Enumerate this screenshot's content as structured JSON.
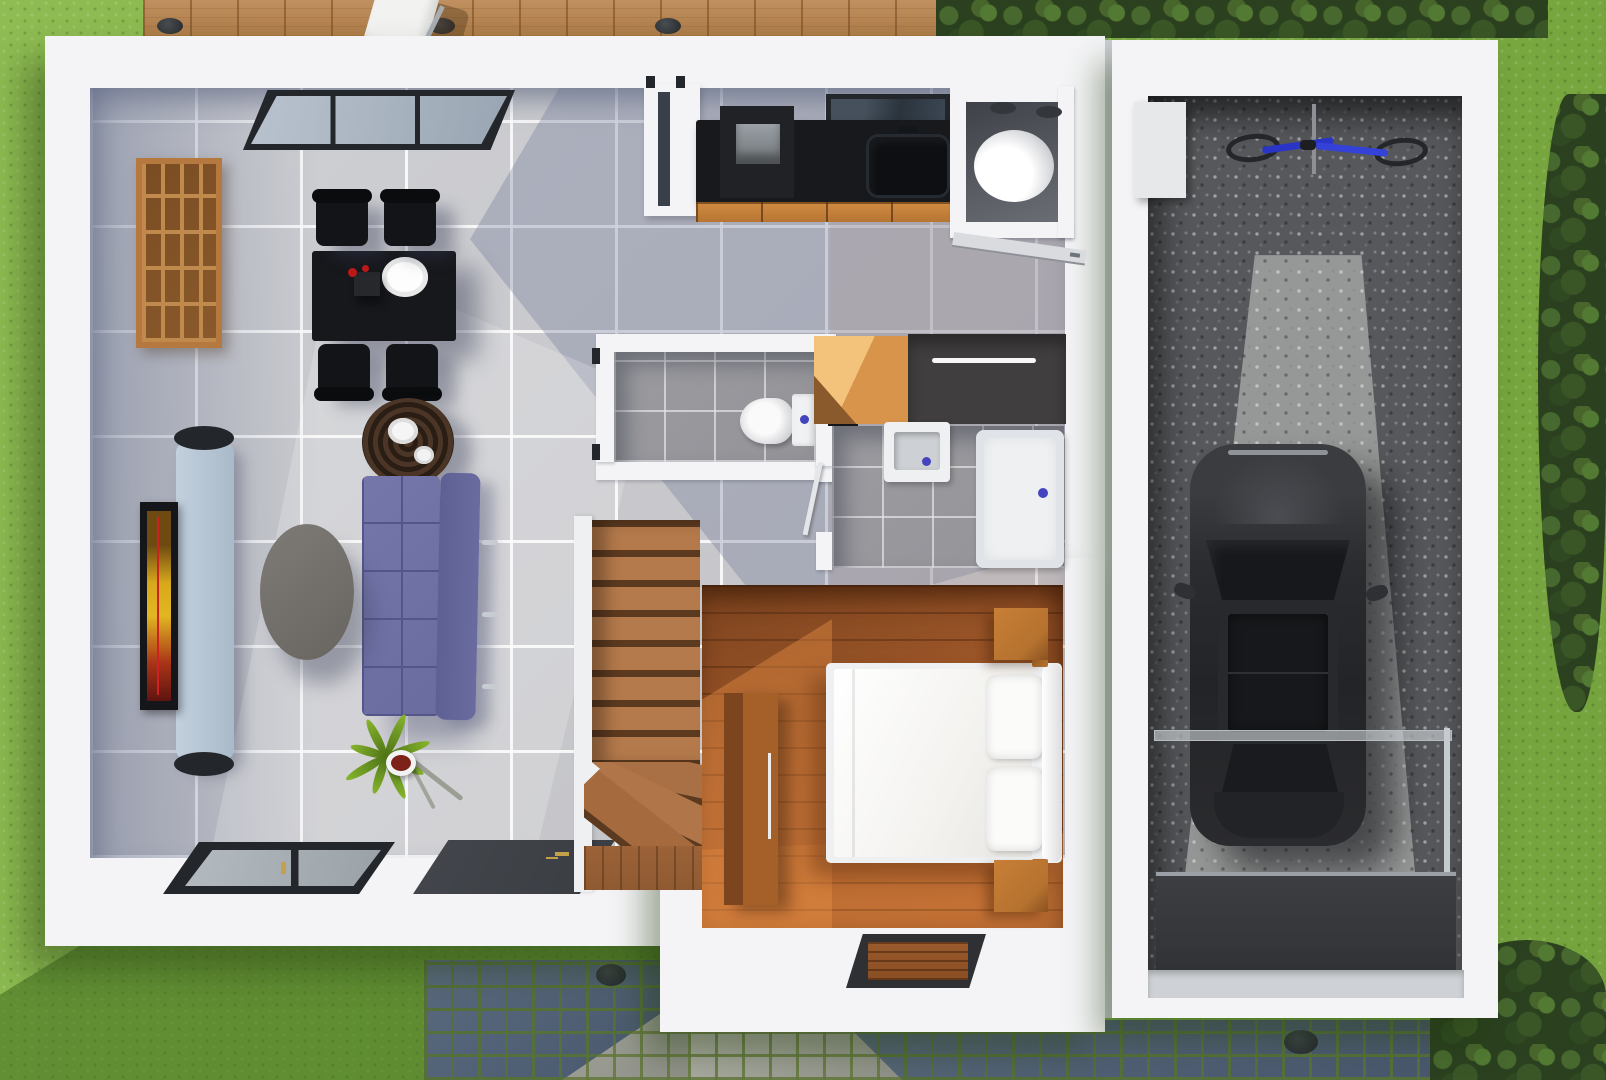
{
  "scene": {
    "description": "3D rendered top-down floor plan of a single-storey house with attached garage, lawn, wooden deck and cobblestone paths",
    "rooms": [
      {
        "name": "living-dining-room",
        "objects": [
          "bookshelf",
          "dining-table",
          "dining-chairs",
          "round-side-table",
          "purple-sofa",
          "oval-coffee-table",
          "tv-panel",
          "tv",
          "house-plant",
          "sliding-window",
          "front-door"
        ]
      },
      {
        "name": "kitchen",
        "objects": [
          "black-countertop",
          "stove",
          "sink",
          "faucet",
          "wood-cabinets",
          "wall-window"
        ]
      },
      {
        "name": "utility-room",
        "objects": [
          "water-heater",
          "ceiling-vents",
          "open-door"
        ]
      },
      {
        "name": "wc",
        "objects": [
          "toilet",
          "cistern-button"
        ]
      },
      {
        "name": "bathroom",
        "objects": [
          "washbasin",
          "shower-tray",
          "drains",
          "door"
        ]
      },
      {
        "name": "hallway",
        "objects": [
          "orange-closet",
          "dark-wardrobe"
        ]
      },
      {
        "name": "staircase",
        "objects": [
          "wood-steps",
          "winder-steps"
        ]
      },
      {
        "name": "bedroom",
        "objects": [
          "double-bed",
          "pillows",
          "nightstands",
          "wardrobe",
          "doormat"
        ]
      },
      {
        "name": "garage",
        "objects": [
          "car",
          "bicycle",
          "wall-unit",
          "glass-railing",
          "entry-ramp"
        ]
      }
    ],
    "outdoor": [
      "lawn",
      "wooden-deck",
      "deck-lounge-chair",
      "tree-canopies",
      "cobblestone-path",
      "storm-drains",
      "gravel-floor"
    ]
  },
  "colors": {
    "grassBase": "#7fae45",
    "grassLight": "#8fbd53",
    "grassShadow": "#3f6b1e",
    "treeDark": "#2b401f",
    "deckWood": "#c09060",
    "deckSeam": "#744820",
    "cobbleJoint": "#55703a",
    "cobbleDark1": "#5a6a7e",
    "cobbleDark2": "#47566b",
    "cobbleL1": "#b0b1a7",
    "cobbleL2": "#8f9188",
    "wallWhite": "#f4f4f6",
    "wallShade": "#ccd0d6",
    "tileBase1": "#cfd0d4",
    "tileBase2": "#c2c2c6",
    "counterBlack": "#17191d",
    "cabinetWood": "#cf8a41",
    "stoveGray": "#9aa0a5",
    "frameDark": "#23262b",
    "glass1": "#b9c3cf",
    "glass2": "#99a5b2",
    "bathTile": "#939398",
    "fixtureWhite": "#eef0f2",
    "drainBlue": "#4444bf",
    "closetOrangeA": "#f3c37c",
    "closetOrangeB": "#d9944b",
    "closetDark": "#413e3f",
    "utilityDark": "#595c63",
    "boilerWhite": "#ffffff",
    "woodA": "#7c431e",
    "woodB": "#a2592a",
    "woodSun": "#e89045",
    "stairWood": "#b57a4b",
    "stairShadow": "#5c3a20",
    "bedWhite": "#f3f2ef",
    "nightWood": "#b5722f",
    "wardrobeA": "#7c451d",
    "wardrobeB": "#a55f28",
    "sofaPurple": "#6a6b9f",
    "sofaSeam": "#54558a",
    "tableBlack": "#17181c",
    "chairBlack": "#131417",
    "tvPanelA": "#c2d0de",
    "tvPanelB": "#a9bac9",
    "tvFrame": "#15161a",
    "screenAmber": "#e2b722",
    "screenRed": "#a83417",
    "coffeeA": "#7e7b76",
    "coffeeB": "#686560",
    "sideWoodA": "#4a3526",
    "sideWoodB": "#2a1d14",
    "plantGreen": "#6b9623",
    "potMaroon": "#7c2218",
    "gravelBase": "#56585b",
    "gravelLight": "#a2a4a3",
    "carBody": "#2b2c2f",
    "carGlass": "#17181b",
    "carLight": "#4b4d52",
    "rampDark": "#35373b",
    "sillGray": "#ced1d5",
    "doorDark": "#3a3d42",
    "gold": "#c5a04a",
    "matWood": "#9a5a2c",
    "bikeBlue": "#2a35c8"
  }
}
